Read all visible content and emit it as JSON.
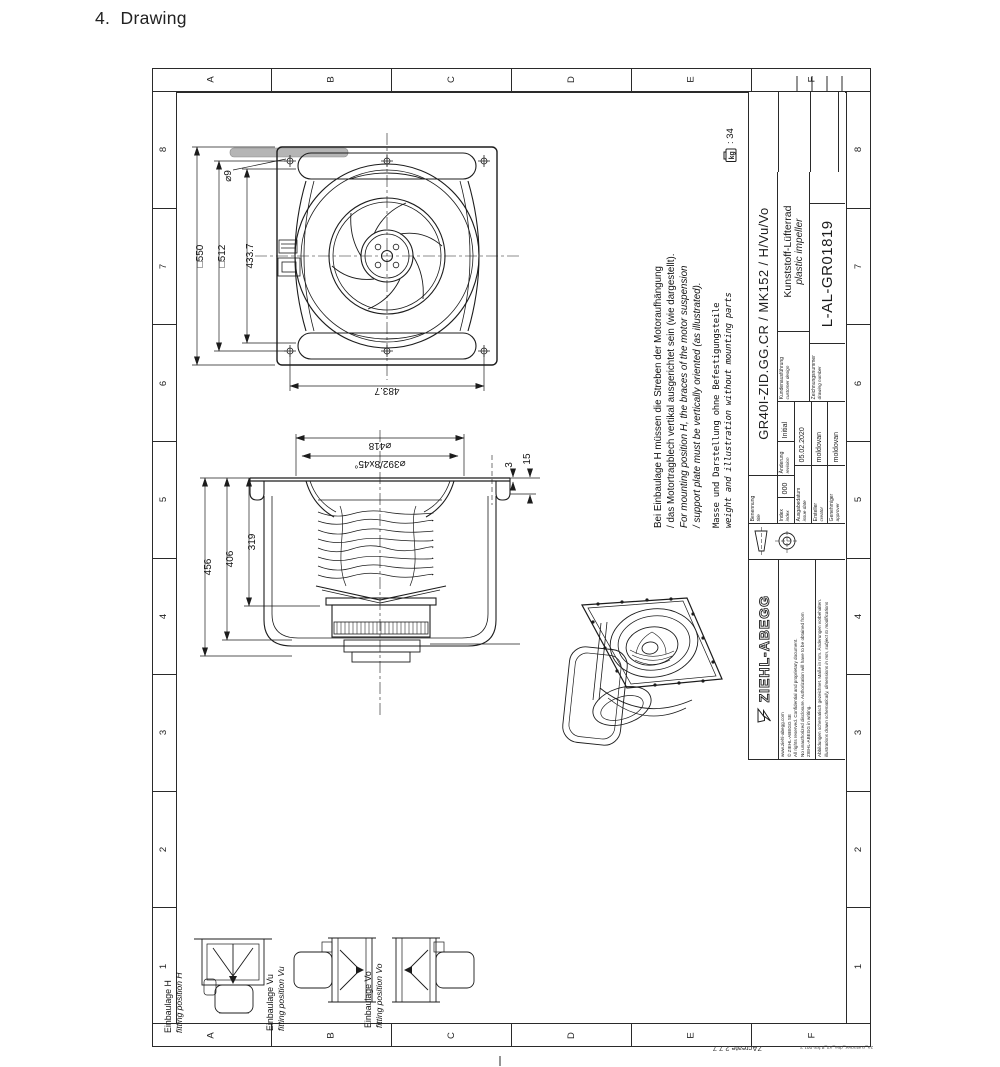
{
  "page": {
    "heading": "4.  Drawing"
  },
  "frame": {
    "letters": [
      "A",
      "B",
      "C",
      "D",
      "E",
      "F"
    ],
    "numbers": [
      "8",
      "7",
      "6",
      "5",
      "4",
      "3",
      "2",
      "1"
    ],
    "app_version": "ZAcreate 2.7.7",
    "form_ref": "za_customer_drw_a3_8 frm 001 2"
  },
  "weight": {
    "unit": "kg",
    "value": ": 34"
  },
  "notes": {
    "de1": "Bei Einbaulage H müssen die Streben der Motoraufhängung",
    "de2": "/ das Motortragblech vertikal ausgerichtet sein (wie dargestellt).",
    "en1": "For mounting position H, the braces of the motor suspension",
    "en2": "/ support plate must be vertically oriented (as illustrated).",
    "mass_de": "Masse und Darstellung ohne Befestigungsteile",
    "mass_en": "weight and illustration without mounting parts"
  },
  "titleblock": {
    "benennung_label": "Benennung",
    "title_label": "title",
    "part_name": "GR40I-ZID.GG.CR / MK152 / H/Vu/Vo",
    "product_de": "Kunststoff-Lüfterrad",
    "product_en": "plastic impeller",
    "design_de": "Kundenausführung",
    "design_en": "customer design",
    "number_label_de": "Zeichnungsnummer",
    "number_label_en": "drawing number",
    "drawing_number": "L-AL-GR01819",
    "logo_text": "ZIEHL-ABEGG",
    "fineprint1": "www.ziehl-abegg.com",
    "fineprint2": "© ZIEHL-ABEGG SE",
    "fineprint3": "All rights reserved. Confidential and proprietary document.",
    "fineprint4": "No unauthorized disclosure. Authorization will have to be obtained from",
    "fineprint5": "ZIEHL-ABEGG in writing.",
    "fineprint6": "Abbildungen schematisch gezeichnet. Maße in mm. Änderungen vorbehalten.",
    "fineprint7": "illustrations drawn schematically, dimensions in mm, subject to modifications",
    "rev": {
      "index_de": "Index",
      "index_en": "index",
      "index_val": "000",
      "change_de": "Änderung",
      "change_en": "revision",
      "change_val": "Initial",
      "date_de": "Ausgabedatum",
      "date_en": "issue date",
      "date_val": "05.02.2020",
      "creator_de": "Ersteller",
      "creator_en": "creator",
      "creator_val": "moldovan",
      "approver_de": "Genehmiger",
      "approver_en": "approver",
      "approver_val": "moldovan"
    }
  },
  "dims": {
    "d550": "□550",
    "d512": "□512",
    "d433": "433.7",
    "d9": "⌀9",
    "d483": "483.7",
    "d418": "⌀418",
    "d392": "⌀392/8x45°",
    "d456": "456",
    "d406": "406",
    "d319": "319",
    "d3": "3",
    "d15": "15"
  },
  "fitting": {
    "h_de": "Einbaulage H",
    "h_en": "fitting position H",
    "vu_de": "Einbaulage Vu",
    "vu_en": "fitting position Vu",
    "vo_de": "Einbaulage Vo",
    "vo_en": "fitting position Vo"
  }
}
